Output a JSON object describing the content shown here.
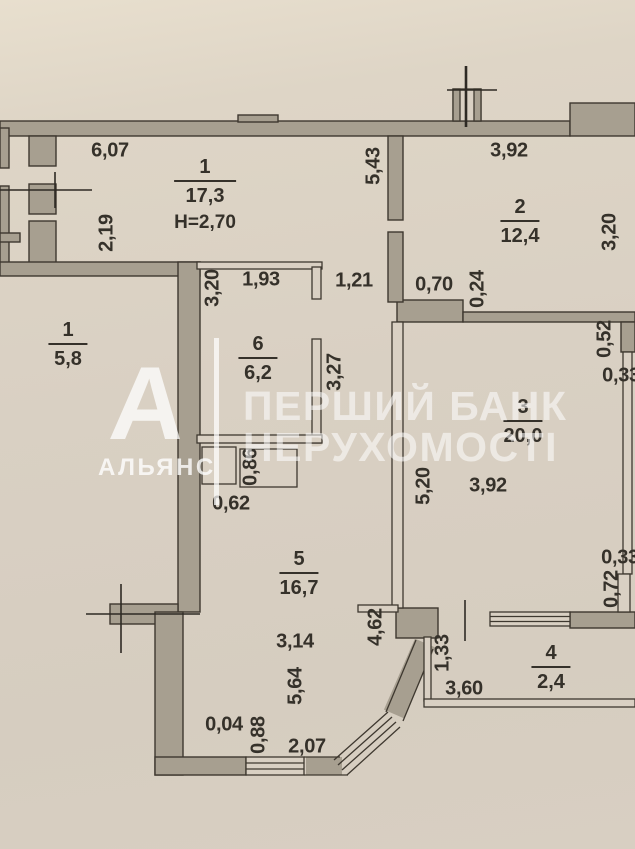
{
  "watermark": {
    "logo_letter": "А",
    "logo_name": "АЛЬЯНС",
    "bank_line1": "ПЕРШИЙ БАНК",
    "bank_line2": "НЕРУХОМОСТІ",
    "color": "#ffffff"
  },
  "palette": {
    "paper": "#d9d0c3",
    "wall_fill": "#a79f90",
    "line": "#3e382f",
    "text": "#35312a"
  },
  "rooms": [
    {
      "number": "1",
      "area": "17,3",
      "height_note": "H=2,70"
    },
    {
      "number": "2",
      "area": "12,4"
    },
    {
      "number": "3",
      "area": "20,0"
    },
    {
      "number": "4",
      "area": "2,4"
    },
    {
      "number": "5",
      "area": "16,7"
    },
    {
      "number": "6",
      "area": "6,2"
    },
    {
      "number": "1",
      "area": "5,8"
    }
  ],
  "dims": {
    "d607": "6,07",
    "d219": "2,19",
    "d543": "5,43",
    "d392a": "3,92",
    "d320a": "3,20",
    "d193": "1,93",
    "d320b": "3,20",
    "d121": "1,21",
    "d070": "0,70",
    "d024": "0,24",
    "d327": "3,27",
    "d052": "0,52",
    "d033a": "0,33",
    "d520": "5,20",
    "d392b": "3,92",
    "d086": "0,86",
    "d062": "0,62",
    "d314": "3,14",
    "d564": "5,64",
    "d462": "4,62",
    "d133": "1,33",
    "d360": "3,60",
    "d033b": "0,33",
    "d072": "0,72",
    "d004": "0,04",
    "d088": "0,88",
    "d207": "2,07"
  }
}
